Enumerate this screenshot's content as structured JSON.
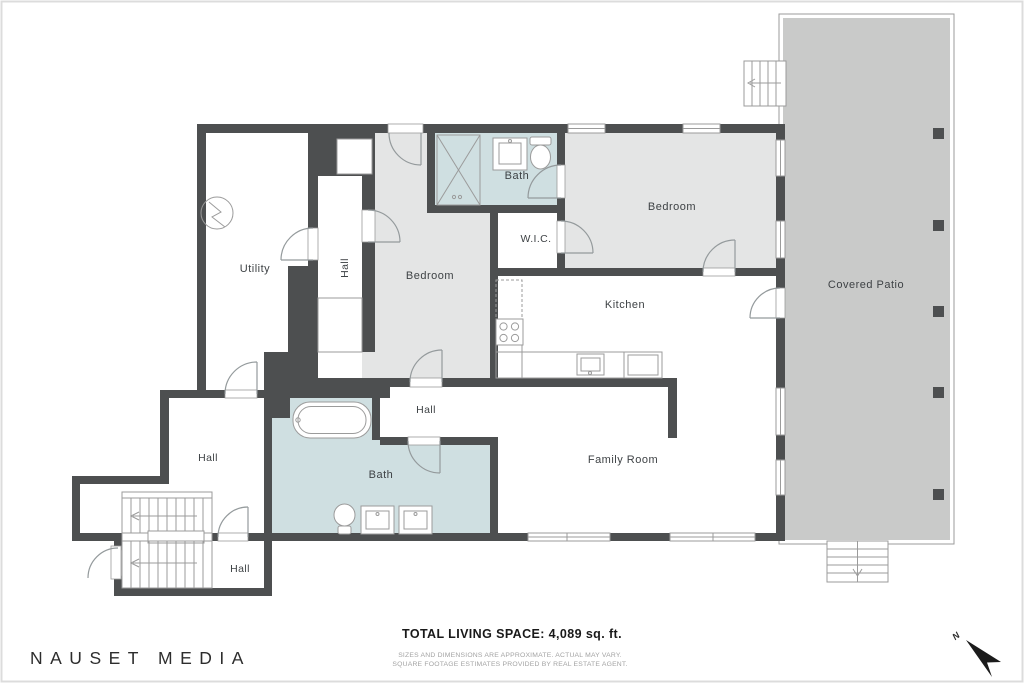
{
  "branding": {
    "studio_name": "NAUSET MEDIA"
  },
  "summary": {
    "total_living_space": "TOTAL LIVING SPACE: 4,089 sq. ft.",
    "disclaimer_line1": "SIZES AND DIMENSIONS ARE APPROXIMATE. ACTUAL MAY VARY.",
    "disclaimer_line2": "SQUARE FOOTAGE ESTIMATES PROVIDED BY REAL ESTATE AGENT."
  },
  "compass": {
    "north_label": "N"
  },
  "rooms": {
    "utility": "Utility",
    "hall_upper": "Hall",
    "bedroom_middle": "Bedroom",
    "bath_top": "Bath",
    "wic": "W.I.C.",
    "bedroom_right": "Bedroom",
    "kitchen": "Kitchen",
    "covered_patio": "Covered Patio",
    "hall_middle": "Hall",
    "family_room": "Family Room",
    "bath_bottom": "Bath",
    "hall_lower": "Hall",
    "hall_bottom": "Hall"
  },
  "colors": {
    "wall": "#4d4f50",
    "bedroom_fill": "#e4e5e5",
    "bath_fill": "#cfdfe1",
    "patio_fill": "#c9cac9",
    "line": "#9b9b9b",
    "label_text": "#3e4245"
  }
}
